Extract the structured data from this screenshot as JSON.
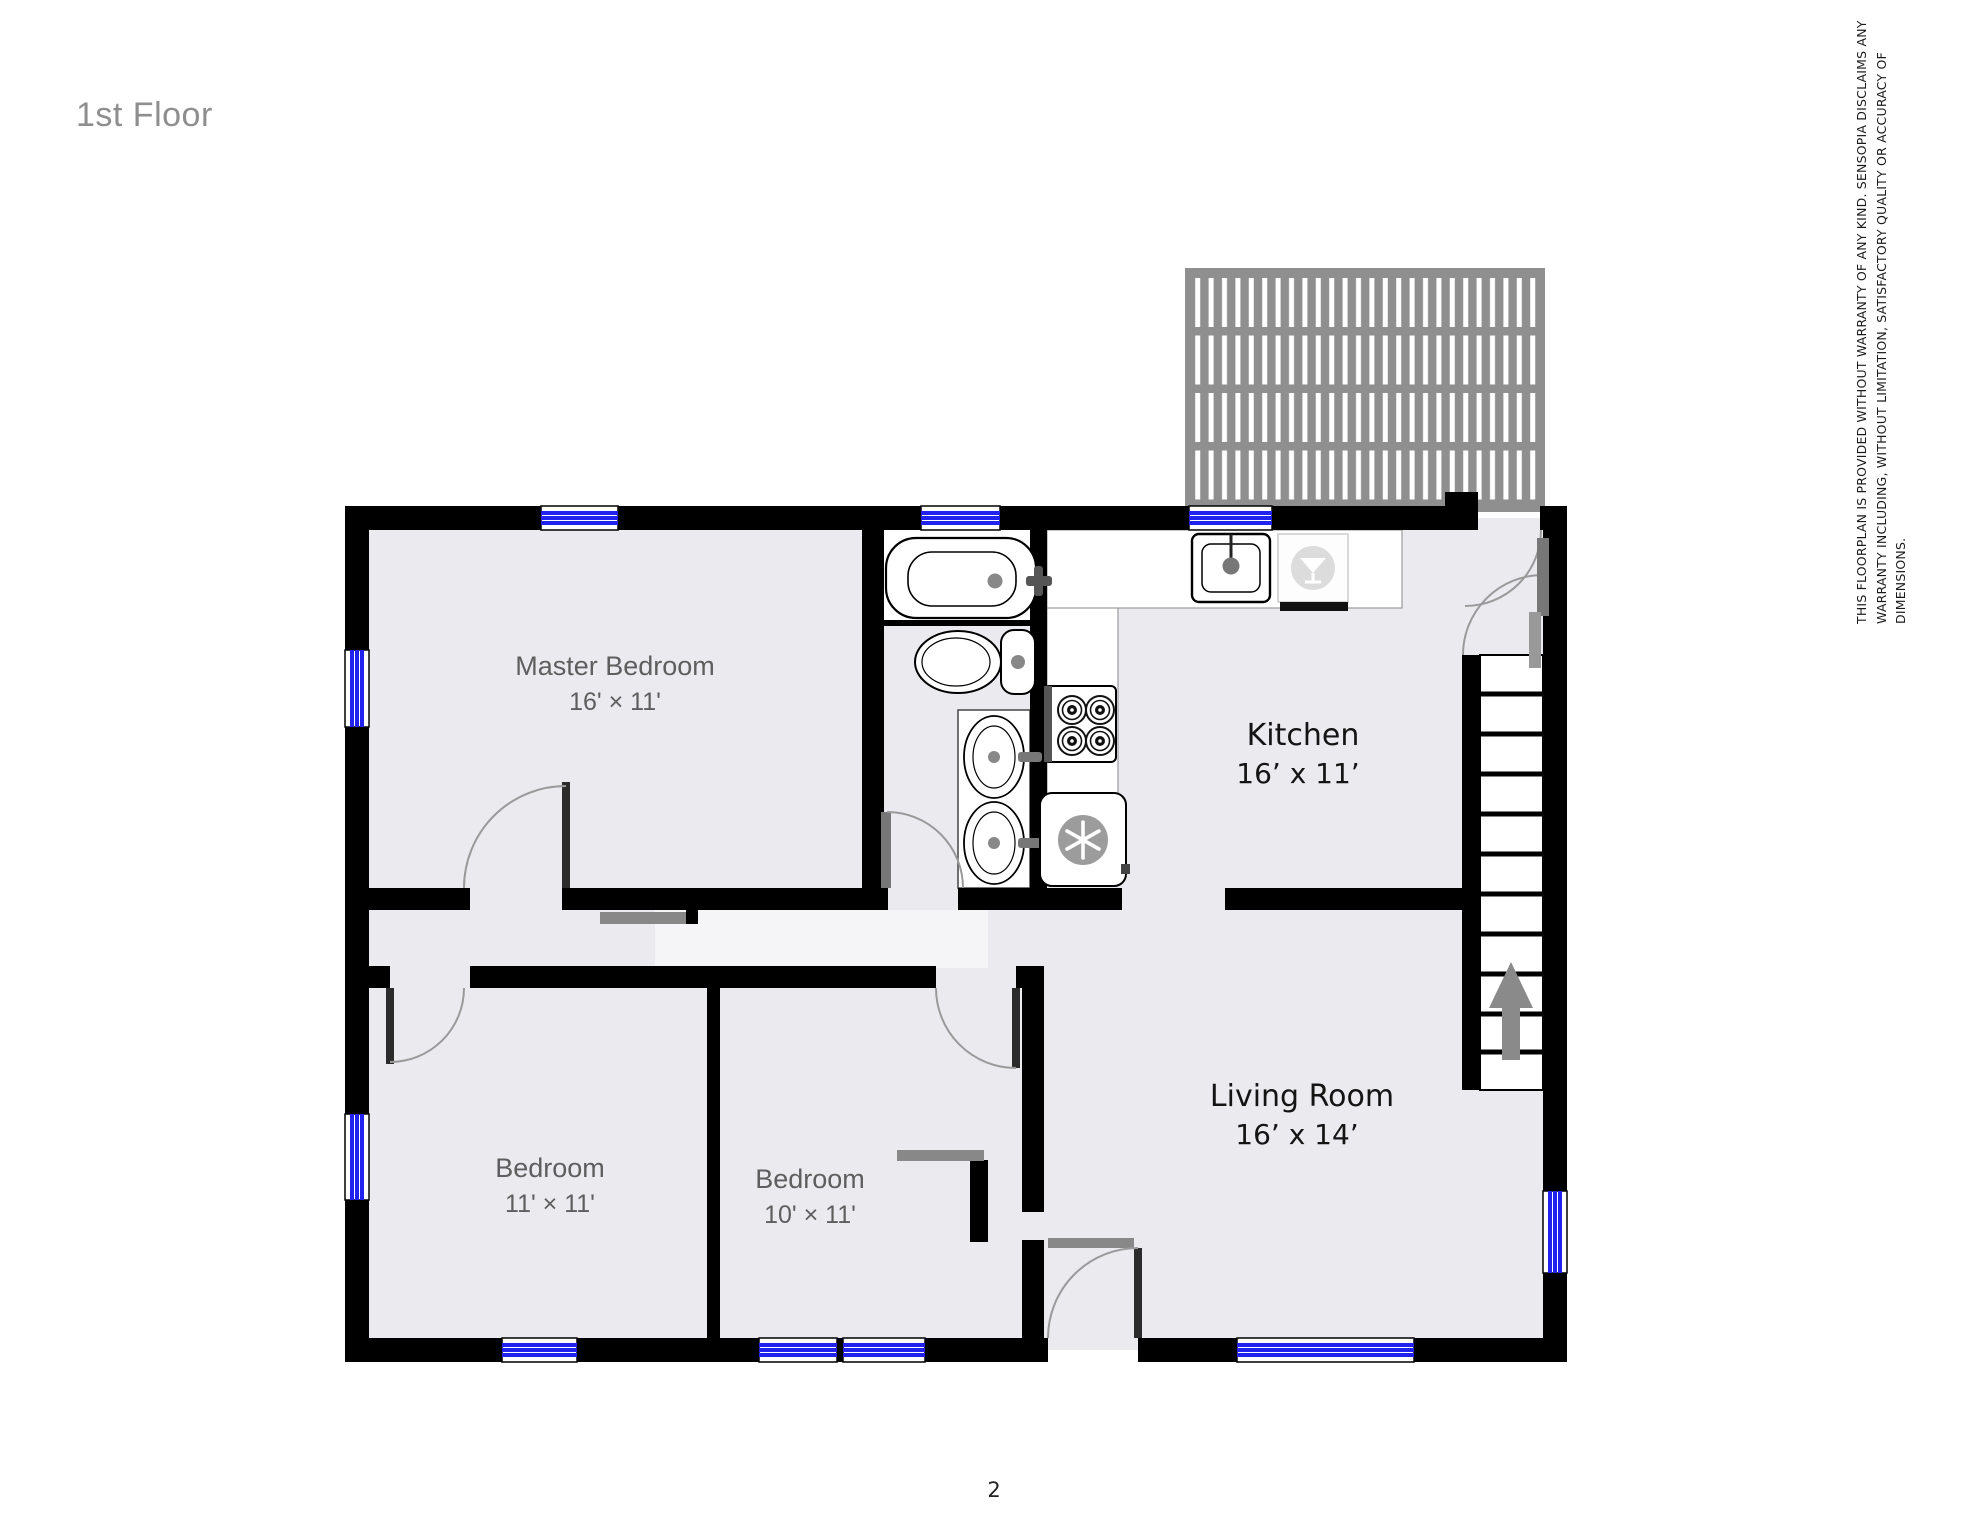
{
  "page": {
    "title": "1st Floor",
    "number": "2"
  },
  "disclaimer": {
    "lines": [
      "THIS FLOORPLAN IS PROVIDED WITHOUT WARRANTY OF ANY KIND. SENSOPIA DISCLAIMS ANY",
      "WARRANTY INCLUDING, WITHOUT LIMITATION, SATISFACTORY QUALITY OR ACCURACY OF",
      "DIMENSIONS."
    ]
  },
  "rooms": {
    "master_bedroom": {
      "name": "Master Bedroom",
      "dims": "16' × 11'"
    },
    "kitchen": {
      "name": "Kitchen",
      "dims": "16’ x 11’"
    },
    "living_room": {
      "name": "Living Room",
      "dims": "16’ x 14’"
    },
    "bedroom_left": {
      "name": "Bedroom",
      "dims": "11' × 11'"
    },
    "bedroom_middle": {
      "name": "Bedroom",
      "dims": "10' × 11'"
    }
  },
  "icons": {
    "refrigerator": "snowflake-icon",
    "dishwasher": "martini-glass-icon",
    "stairs_direction": "up-arrow-icon"
  },
  "colors": {
    "wall": "#000000",
    "window_glass": "#2222ee",
    "deck": "#8f8f8f",
    "floor": "#ebebef",
    "hall_floor": "#f5f5f7",
    "label_gray": "#5e5e5e",
    "label_dark": "#141414",
    "title_gray": "#8e8e8e",
    "door_arc": "#9a9a9a"
  }
}
